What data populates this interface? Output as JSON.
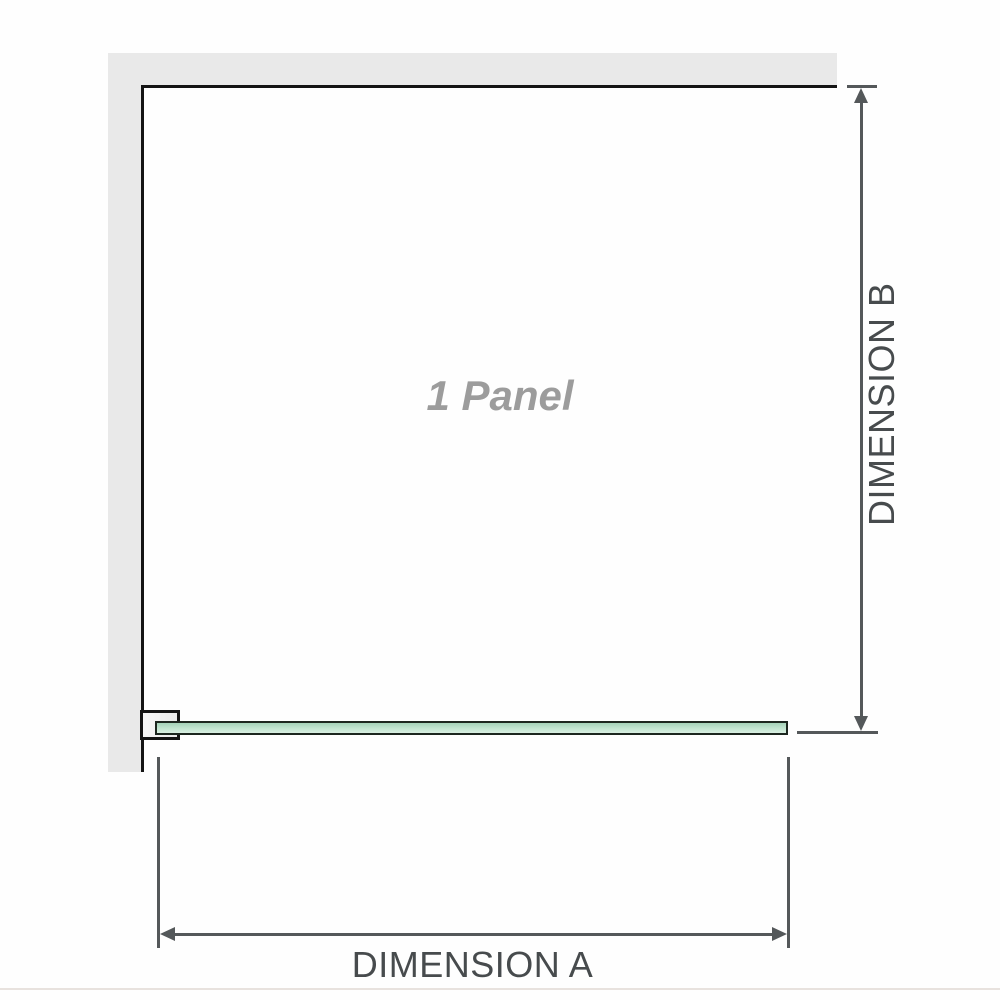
{
  "diagram": {
    "panel_label": "1 Panel",
    "dimension_a": {
      "label": "DIMENSION A"
    },
    "dimension_b": {
      "label": "DIMENSION B"
    }
  },
  "colors": {
    "page_bg": "#fefefe",
    "wall_fill": "#e9e9e9",
    "wall_edge": "#141414",
    "glass_border": "#1c261f",
    "glass_top": "#a4d2b8",
    "glass_mid": "#c2e5d0",
    "glass_bottom": "#d9efe2",
    "bracket_fill": "#ebebeb",
    "dim_line": "#54585a",
    "label_text": "#474b4d",
    "panel_text": "#9c9c9c",
    "divider": "#e8e2de"
  }
}
